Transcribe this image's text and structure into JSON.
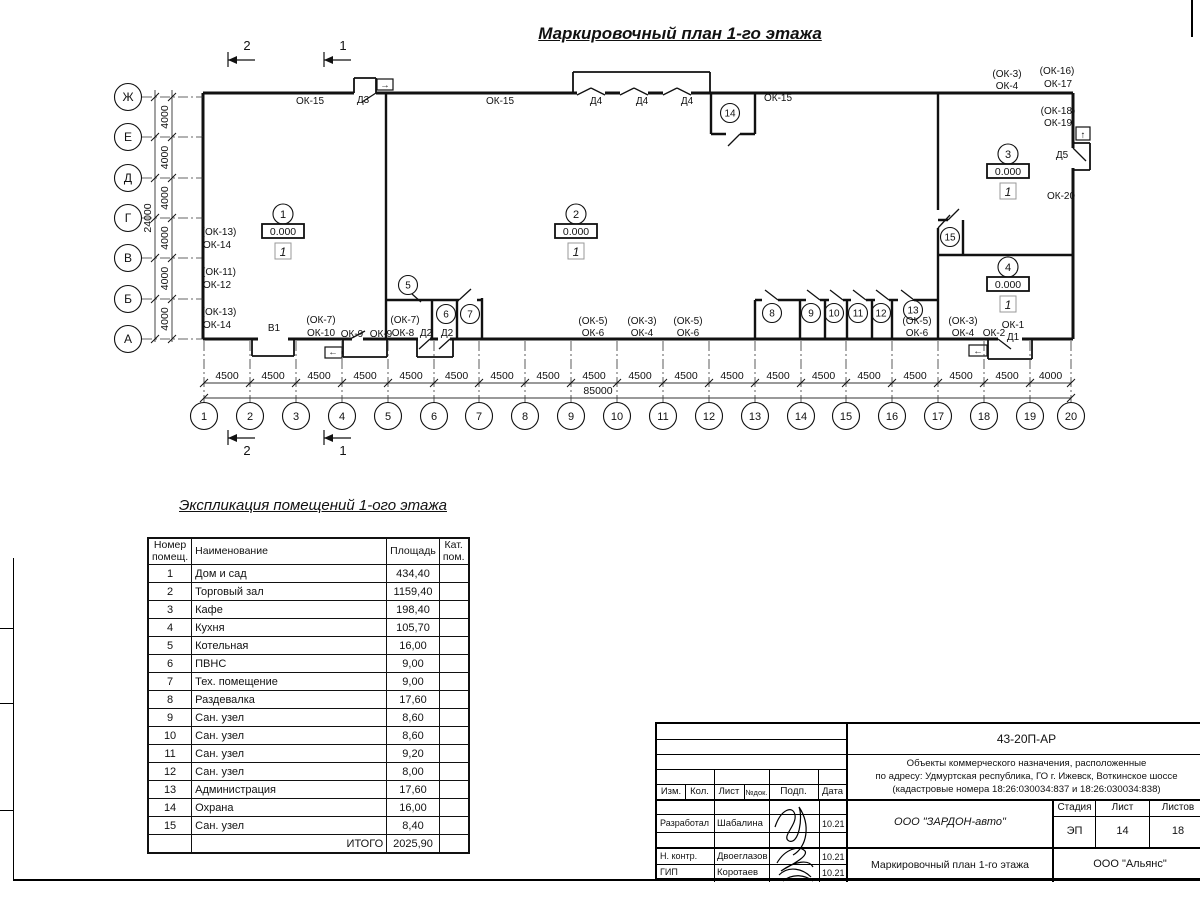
{
  "title": "Маркировочный план 1-го этажа",
  "plan": {
    "left_axes": [
      "Ж",
      "Е",
      "Д",
      "Г",
      "В",
      "Б",
      "А"
    ],
    "left_dims": [
      "4000",
      "4000",
      "4000",
      "4000",
      "4000",
      "4000"
    ],
    "left_total": "24000",
    "bottom_axes": [
      "1",
      "2",
      "3",
      "4",
      "5",
      "6",
      "7",
      "8",
      "9",
      "10",
      "11",
      "12",
      "13",
      "14",
      "15",
      "16",
      "17",
      "18",
      "19",
      "20"
    ],
    "bottom_dims": [
      "4500",
      "4500",
      "4500",
      "4500",
      "4500",
      "4500",
      "4500",
      "4500",
      "4500",
      "4500",
      "4500",
      "4500",
      "4500",
      "4500",
      "4500",
      "4500",
      "4500",
      "4500",
      "4000"
    ],
    "bottom_total": "85000",
    "section_marks": [
      "2",
      "1"
    ],
    "rooms": [
      {
        "num": "1",
        "elev": "0.000",
        "mark": "1",
        "x": 283,
        "y": 214
      },
      {
        "num": "2",
        "elev": "0.000",
        "mark": "1",
        "x": 576,
        "y": 214
      },
      {
        "num": "3",
        "elev": "0.000",
        "mark": "1",
        "x": 1008,
        "y": 154
      },
      {
        "num": "4",
        "elev": "0.000",
        "mark": "1",
        "x": 1008,
        "y": 267
      }
    ],
    "small_rooms": [
      {
        "num": "5",
        "x": 408,
        "y": 285
      },
      {
        "num": "6",
        "x": 446,
        "y": 314
      },
      {
        "num": "7",
        "x": 470,
        "y": 314
      },
      {
        "num": "8",
        "x": 772,
        "y": 313
      },
      {
        "num": "9",
        "x": 811,
        "y": 313
      },
      {
        "num": "10",
        "x": 834,
        "y": 313
      },
      {
        "num": "11",
        "x": 858,
        "y": 313
      },
      {
        "num": "12",
        "x": 881,
        "y": 313
      },
      {
        "num": "13",
        "x": 913,
        "y": 310
      },
      {
        "num": "14",
        "x": 730,
        "y": 113
      },
      {
        "num": "15",
        "x": 950,
        "y": 237
      }
    ],
    "labels": [
      {
        "t": "ОК-15",
        "x": 310,
        "y": 104
      },
      {
        "t": "Д3",
        "x": 363,
        "y": 103
      },
      {
        "t": "ОК-15",
        "x": 500,
        "y": 104
      },
      {
        "t": "Д4",
        "x": 596,
        "y": 104
      },
      {
        "t": "Д4",
        "x": 642,
        "y": 104
      },
      {
        "t": "Д4",
        "x": 687,
        "y": 104
      },
      {
        "t": "ОК-15",
        "x": 778,
        "y": 101
      },
      {
        "t": "(ОК-3)",
        "x": 1007,
        "y": 77
      },
      {
        "t": "ОК-4",
        "x": 1007,
        "y": 89
      },
      {
        "t": "(ОК-16)",
        "x": 1057,
        "y": 74
      },
      {
        "t": "ОК-17",
        "x": 1058,
        "y": 87
      },
      {
        "t": "(ОК-18)",
        "x": 1058,
        "y": 114
      },
      {
        "t": "ОК-19",
        "x": 1058,
        "y": 126
      },
      {
        "t": "Д5",
        "x": 1062,
        "y": 158
      },
      {
        "t": "ОК-20",
        "x": 1061,
        "y": 199
      },
      {
        "t": "(ОК-13)",
        "x": 219,
        "y": 235
      },
      {
        "t": "ОК-14",
        "x": 217,
        "y": 248
      },
      {
        "t": "(ОК-11)",
        "x": 219,
        "y": 275
      },
      {
        "t": "ОК-12",
        "x": 217,
        "y": 288
      },
      {
        "t": "(ОК-13)",
        "x": 219,
        "y": 315
      },
      {
        "t": "ОК-14",
        "x": 217,
        "y": 328
      },
      {
        "t": "В1",
        "x": 274,
        "y": 331
      },
      {
        "t": "(ОК-7)",
        "x": 321,
        "y": 323
      },
      {
        "t": "ОК-10",
        "x": 321,
        "y": 336
      },
      {
        "t": "ОК-9",
        "x": 352,
        "y": 337
      },
      {
        "t": "ОК-9",
        "x": 381,
        "y": 337
      },
      {
        "t": "(ОК-7)",
        "x": 405,
        "y": 323
      },
      {
        "t": "ОК-8",
        "x": 403,
        "y": 336
      },
      {
        "t": "Д2",
        "x": 426,
        "y": 336
      },
      {
        "t": "Д2",
        "x": 447,
        "y": 336
      },
      {
        "t": "(ОК-5)",
        "x": 593,
        "y": 324
      },
      {
        "t": "ОК-6",
        "x": 593,
        "y": 336
      },
      {
        "t": "(ОК-3)",
        "x": 642,
        "y": 324
      },
      {
        "t": "ОК-4",
        "x": 642,
        "y": 336
      },
      {
        "t": "(ОК-5)",
        "x": 688,
        "y": 324
      },
      {
        "t": "ОК-6",
        "x": 688,
        "y": 336
      },
      {
        "t": "(ОК-5)",
        "x": 917,
        "y": 324
      },
      {
        "t": "ОК-6",
        "x": 917,
        "y": 336
      },
      {
        "t": "(ОК-3)",
        "x": 963,
        "y": 324
      },
      {
        "t": "ОК-4",
        "x": 963,
        "y": 336
      },
      {
        "t": "ОК-2",
        "x": 994,
        "y": 336
      },
      {
        "t": "ОК-1",
        "x": 1013,
        "y": 328
      },
      {
        "t": "Д1",
        "x": 1013,
        "y": 340
      }
    ],
    "entry_arrows": [
      {
        "t": "→",
        "x": 385,
        "y": 88
      },
      {
        "t": "↑",
        "x": 1083,
        "y": 138
      },
      {
        "t": "←",
        "x": 978,
        "y": 354
      },
      {
        "t": "←",
        "x": 333,
        "y": 355
      }
    ]
  },
  "table": {
    "title": "Экспликация помещений 1-ого этажа",
    "headers": [
      "Номер\nпомещ.",
      "Наименование",
      "Площадь",
      "Кат.\nпом."
    ],
    "rows": [
      [
        "1",
        "Дом и сад",
        "434,40"
      ],
      [
        "2",
        "Торговый зал",
        "1159,40"
      ],
      [
        "3",
        "Кафе",
        "198,40"
      ],
      [
        "4",
        "Кухня",
        "105,70"
      ],
      [
        "5",
        "Котельная",
        "16,00"
      ],
      [
        "6",
        "ПВНС",
        "9,00"
      ],
      [
        "7",
        "Тех. помещение",
        "9,00"
      ],
      [
        "8",
        "Раздевалка",
        "17,60"
      ],
      [
        "9",
        "Сан. узел",
        "8,60"
      ],
      [
        "10",
        "Сан. узел",
        "8,60"
      ],
      [
        "11",
        "Сан. узел",
        "9,20"
      ],
      [
        "12",
        "Сан. узел",
        "8,00"
      ],
      [
        "13",
        "Администрация",
        "17,60"
      ],
      [
        "14",
        "Охрана",
        "16,00"
      ],
      [
        "15",
        "Сан. узел",
        "8,40"
      ]
    ],
    "total_label": "ИТОГО",
    "total_value": "2025,90"
  },
  "titleblock": {
    "doc_number": "43-20П-АР",
    "object_lines": [
      "Объекты коммерческого назначения, расположенные",
      "по адресу: Удмуртская республика, ГО г. Ижевск, Воткинское шоссе",
      "(кадастровые номера 18:26:030034:837 и 18:26:030034:838)"
    ],
    "columns": [
      "Изм.",
      "Кол.",
      "Лист",
      "№док.",
      "Подп.",
      "Дата"
    ],
    "stage_label": "Стадия",
    "sheet_label": "Лист",
    "sheets_label": "Листов",
    "stage": "ЭП",
    "sheet": "14",
    "sheets": "18",
    "roles": [
      {
        "role": "Разработал",
        "name": "Шабалина",
        "date": "10.21"
      },
      {
        "role": "Н. контр.",
        "name": "Двоеглазов",
        "date": "10.21"
      },
      {
        "role": "ГИП",
        "name": "Коротаев",
        "date": "10.21"
      }
    ],
    "org1": "ООО \"ЗАРДОН-авто\"",
    "drawing_name": "Маркировочный план 1-го этажа",
    "org2": "ООО \"Альянс\""
  }
}
